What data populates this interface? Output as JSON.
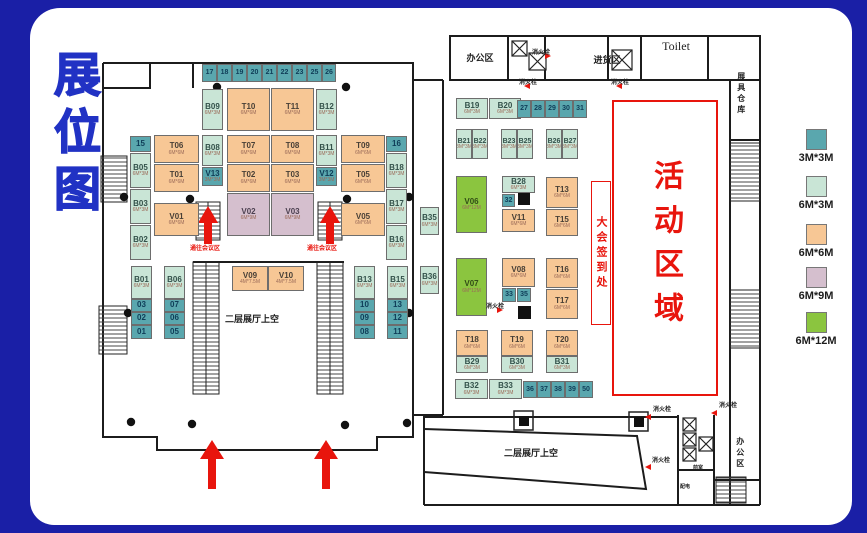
{
  "title": "展位图",
  "zones": {
    "registration": {
      "text": "大会签到处"
    },
    "activity": {
      "text": "活动区域"
    }
  },
  "legend": {
    "x": 806,
    "items": [
      {
        "size": "3M*3M",
        "color": "#5aa7ae",
        "y": 129
      },
      {
        "size": "6M*3M",
        "color": "#c9e5d6",
        "y": 176
      },
      {
        "size": "6M*6M",
        "color": "#f7c795",
        "y": 224
      },
      {
        "size": "6M*9M",
        "color": "#d5bfce",
        "y": 267
      },
      {
        "size": "6M*12M",
        "color": "#8bc53f",
        "y": 312
      }
    ]
  },
  "booth_types": {
    "teal": {
      "size": "3M*3M",
      "color": "#5aa7ae"
    },
    "lg": {
      "size": "6M*3M",
      "color": "#c9e5d6"
    },
    "or": {
      "size": "6M*6M",
      "color": "#f7c795"
    },
    "pu": {
      "size": "6M*9M",
      "color": "#d5bfce"
    },
    "gr": {
      "size": "6M*12M",
      "color": "#8bc53f"
    }
  },
  "accent_colors": {
    "red": "#e8150d",
    "title_blue": "#2132c4",
    "frame_blue": "#1a1fa6"
  },
  "areas": [
    {
      "name": "office-area-top",
      "text": "办公区",
      "x": 454,
      "y": 54,
      "size": 9,
      "w": 52
    },
    {
      "name": "fire-hydrant-label",
      "text": "消火栓",
      "x": 532,
      "y": 50,
      "size": 6
    },
    {
      "name": "goods-area",
      "text": "进货区",
      "x": 577,
      "y": 56,
      "size": 9,
      "w": 60
    },
    {
      "name": "toilet",
      "text": "Toilet",
      "x": 647,
      "y": 40,
      "size": 12,
      "w": 58,
      "serif": true
    },
    {
      "name": "fire-hydrant-label",
      "text": "消火栓",
      "x": 519,
      "y": 80,
      "size": 6
    },
    {
      "name": "fire-hydrant-label",
      "text": "消火栓",
      "x": 611,
      "y": 80,
      "size": 6
    },
    {
      "name": "warehouse",
      "text": "展具仓库",
      "x": 736,
      "y": 72,
      "size": 8,
      "vertical": true
    },
    {
      "name": "to-conference-label",
      "text": "通往会议区",
      "x": 190,
      "y": 246,
      "size": 6,
      "color": "#e8150d"
    },
    {
      "name": "to-conference-label",
      "text": "通往会议区",
      "x": 307,
      "y": 246,
      "size": 6,
      "color": "#e8150d"
    },
    {
      "name": "void-left",
      "text": "二层展厅上空",
      "x": 225,
      "y": 315,
      "size": 9
    },
    {
      "name": "fire-hydrant-label",
      "text": "消火栓",
      "x": 486,
      "y": 304,
      "size": 6
    },
    {
      "name": "void-bottom",
      "text": "二层展厅上空",
      "x": 504,
      "y": 449,
      "size": 9
    },
    {
      "name": "fire-hydrant-label",
      "text": "消火栓",
      "x": 653,
      "y": 407,
      "size": 6
    },
    {
      "name": "fire-hydrant-label",
      "text": "消火栓",
      "x": 719,
      "y": 403,
      "size": 6
    },
    {
      "name": "fire-hydrant-label",
      "text": "消火栓",
      "x": 652,
      "y": 458,
      "size": 6
    },
    {
      "name": "front-room",
      "text": "前室",
      "x": 693,
      "y": 466,
      "size": 5
    },
    {
      "name": "power-room",
      "text": "配电",
      "x": 680,
      "y": 485,
      "size": 5
    },
    {
      "name": "office-area-bottom",
      "text": "办公区",
      "x": 735,
      "y": 437,
      "size": 8,
      "vertical": true
    }
  ],
  "booths": [
    {
      "label": "17",
      "type": "teal",
      "x": 202,
      "y": 64,
      "w": 15,
      "h": 18
    },
    {
      "label": "18",
      "type": "teal",
      "x": 217,
      "y": 64,
      "w": 15,
      "h": 18
    },
    {
      "label": "19",
      "type": "teal",
      "x": 232,
      "y": 64,
      "w": 15,
      "h": 18
    },
    {
      "label": "20",
      "type": "teal",
      "x": 247,
      "y": 64,
      "w": 15,
      "h": 18
    },
    {
      "label": "21",
      "type": "teal",
      "x": 262,
      "y": 64,
      "w": 15,
      "h": 18
    },
    {
      "label": "22",
      "type": "teal",
      "x": 277,
      "y": 64,
      "w": 15,
      "h": 18
    },
    {
      "label": "23",
      "type": "teal",
      "x": 292,
      "y": 64,
      "w": 15,
      "h": 18
    },
    {
      "label": "25",
      "type": "teal",
      "x": 307,
      "y": 64,
      "w": 15,
      "h": 18
    },
    {
      "label": "26",
      "type": "teal",
      "x": 322,
      "y": 64,
      "w": 14,
      "h": 18
    },
    {
      "label": "B09",
      "type": "lg",
      "sub": "6M*3M",
      "x": 202,
      "y": 89,
      "w": 21,
      "h": 41
    },
    {
      "label": "T10",
      "type": "or",
      "sub": "6M*6M",
      "x": 227,
      "y": 88,
      "w": 43,
      "h": 43
    },
    {
      "label": "T11",
      "type": "or",
      "sub": "6M*6M",
      "x": 271,
      "y": 88,
      "w": 43,
      "h": 43
    },
    {
      "label": "B12",
      "type": "lg",
      "sub": "6M*3M",
      "x": 316,
      "y": 89,
      "w": 21,
      "h": 41
    },
    {
      "label": "15",
      "type": "teal",
      "x": 130,
      "y": 136,
      "w": 21,
      "h": 16
    },
    {
      "label": "B05",
      "type": "lg",
      "sub": "6M*3M",
      "x": 130,
      "y": 153,
      "w": 21,
      "h": 35
    },
    {
      "label": "B03",
      "type": "lg",
      "sub": "6M*3M",
      "x": 130,
      "y": 189,
      "w": 21,
      "h": 35
    },
    {
      "label": "B02",
      "type": "lg",
      "sub": "6M*3M",
      "x": 130,
      "y": 225,
      "w": 21,
      "h": 35
    },
    {
      "label": "T06",
      "type": "or",
      "sub": "6M*6M",
      "x": 154,
      "y": 135,
      "w": 45,
      "h": 28
    },
    {
      "label": "T01",
      "type": "or",
      "sub": "6M*6M",
      "x": 154,
      "y": 164,
      "w": 45,
      "h": 28
    },
    {
      "label": "V01",
      "type": "or",
      "sub": "6M*6M",
      "x": 154,
      "y": 203,
      "w": 45,
      "h": 33
    },
    {
      "label": "B08",
      "type": "lg",
      "sub": "6M*3M",
      "x": 202,
      "y": 135,
      "w": 21,
      "h": 31
    },
    {
      "label": "V13",
      "type": "teal",
      "sub": "3M*3M",
      "x": 202,
      "y": 167,
      "w": 21,
      "h": 19
    },
    {
      "label": "T07",
      "type": "or",
      "sub": "6M*6M",
      "x": 227,
      "y": 135,
      "w": 43,
      "h": 28
    },
    {
      "label": "T02",
      "type": "or",
      "sub": "6M*6M",
      "x": 227,
      "y": 164,
      "w": 43,
      "h": 28
    },
    {
      "label": "V02",
      "type": "pu",
      "sub": "6M*9M",
      "x": 227,
      "y": 193,
      "w": 43,
      "h": 43
    },
    {
      "label": "T08",
      "type": "or",
      "sub": "6M*6M",
      "x": 271,
      "y": 135,
      "w": 43,
      "h": 28
    },
    {
      "label": "T03",
      "type": "or",
      "sub": "6M*6M",
      "x": 271,
      "y": 164,
      "w": 43,
      "h": 28
    },
    {
      "label": "V03",
      "type": "pu",
      "sub": "6M*9M",
      "x": 271,
      "y": 193,
      "w": 43,
      "h": 43
    },
    {
      "label": "B11",
      "type": "lg",
      "sub": "6M*3M",
      "x": 316,
      "y": 135,
      "w": 21,
      "h": 31
    },
    {
      "label": "V12",
      "type": "teal",
      "sub": "3M*3M",
      "x": 316,
      "y": 167,
      "w": 21,
      "h": 19
    },
    {
      "label": "T09",
      "type": "or",
      "sub": "6M*6M",
      "x": 341,
      "y": 135,
      "w": 44,
      "h": 28
    },
    {
      "label": "T05",
      "type": "or",
      "sub": "6M*6M",
      "x": 341,
      "y": 164,
      "w": 44,
      "h": 28
    },
    {
      "label": "V05",
      "type": "or",
      "sub": "6M*6M",
      "x": 341,
      "y": 203,
      "w": 44,
      "h": 33
    },
    {
      "label": "16",
      "type": "teal",
      "x": 386,
      "y": 136,
      "w": 21,
      "h": 16
    },
    {
      "label": "B18",
      "type": "lg",
      "sub": "6M*3M",
      "x": 386,
      "y": 153,
      "w": 21,
      "h": 35
    },
    {
      "label": "B17",
      "type": "lg",
      "sub": "6M*3M",
      "x": 386,
      "y": 189,
      "w": 21,
      "h": 35
    },
    {
      "label": "B16",
      "type": "lg",
      "sub": "6M*3M",
      "x": 386,
      "y": 225,
      "w": 21,
      "h": 35
    },
    {
      "label": "B35",
      "type": "lg",
      "sub": "6M*3M",
      "x": 420,
      "y": 207,
      "w": 19,
      "h": 28
    },
    {
      "label": "B01",
      "type": "lg",
      "sub": "6M*3M",
      "x": 131,
      "y": 266,
      "w": 21,
      "h": 33
    },
    {
      "label": "03",
      "type": "teal",
      "x": 131,
      "y": 299,
      "w": 21,
      "h": 13
    },
    {
      "label": "02",
      "type": "teal",
      "x": 131,
      "y": 312,
      "w": 21,
      "h": 13
    },
    {
      "label": "01",
      "type": "teal",
      "x": 131,
      "y": 325,
      "w": 21,
      "h": 14
    },
    {
      "label": "B06",
      "type": "lg",
      "sub": "6M*3M",
      "x": 164,
      "y": 266,
      "w": 21,
      "h": 33
    },
    {
      "label": "07",
      "type": "teal",
      "x": 164,
      "y": 299,
      "w": 21,
      "h": 13
    },
    {
      "label": "06",
      "type": "teal",
      "x": 164,
      "y": 312,
      "w": 21,
      "h": 13
    },
    {
      "label": "05",
      "type": "teal",
      "x": 164,
      "y": 325,
      "w": 21,
      "h": 14
    },
    {
      "label": "V09",
      "type": "or",
      "sub": "4M*7.5M",
      "x": 232,
      "y": 266,
      "w": 36,
      "h": 25
    },
    {
      "label": "V10",
      "type": "or",
      "sub": "4M*7.5M",
      "x": 268,
      "y": 266,
      "w": 36,
      "h": 25
    },
    {
      "label": "B13",
      "type": "lg",
      "sub": "6M*3M",
      "x": 354,
      "y": 266,
      "w": 21,
      "h": 33
    },
    {
      "label": "10",
      "type": "teal",
      "x": 354,
      "y": 299,
      "w": 21,
      "h": 13
    },
    {
      "label": "09",
      "type": "teal",
      "x": 354,
      "y": 312,
      "w": 21,
      "h": 13
    },
    {
      "label": "08",
      "type": "teal",
      "x": 354,
      "y": 325,
      "w": 21,
      "h": 14
    },
    {
      "label": "B15",
      "type": "lg",
      "sub": "6M*3M",
      "x": 387,
      "y": 266,
      "w": 21,
      "h": 33
    },
    {
      "label": "13",
      "type": "teal",
      "x": 387,
      "y": 299,
      "w": 21,
      "h": 13
    },
    {
      "label": "12",
      "type": "teal",
      "x": 387,
      "y": 312,
      "w": 21,
      "h": 13
    },
    {
      "label": "11",
      "type": "teal",
      "x": 387,
      "y": 325,
      "w": 21,
      "h": 14
    },
    {
      "label": "B36",
      "type": "lg",
      "sub": "6M*3M",
      "x": 420,
      "y": 266,
      "w": 19,
      "h": 28
    },
    {
      "label": "B19",
      "type": "lg",
      "sub": "6M*3M",
      "x": 456,
      "y": 98,
      "w": 32,
      "h": 21
    },
    {
      "label": "B20",
      "type": "lg",
      "sub": "6M*3M",
      "x": 489,
      "y": 98,
      "w": 32,
      "h": 21
    },
    {
      "label": "27",
      "type": "teal",
      "x": 517,
      "y": 100,
      "w": 14,
      "h": 18
    },
    {
      "label": "28",
      "type": "teal",
      "x": 531,
      "y": 100,
      "w": 14,
      "h": 18
    },
    {
      "label": "29",
      "type": "teal",
      "x": 545,
      "y": 100,
      "w": 14,
      "h": 18
    },
    {
      "label": "30",
      "type": "teal",
      "x": 559,
      "y": 100,
      "w": 14,
      "h": 18
    },
    {
      "label": "31",
      "type": "teal",
      "x": 573,
      "y": 100,
      "w": 14,
      "h": 18
    },
    {
      "label": "B21",
      "type": "lg",
      "sub": "3M*3M",
      "x": 456,
      "y": 129,
      "w": 16,
      "h": 30
    },
    {
      "label": "B22",
      "type": "lg",
      "sub": "3M*3M",
      "x": 472,
      "y": 129,
      "w": 16,
      "h": 30
    },
    {
      "label": "B23",
      "type": "lg",
      "sub": "3M*3M",
      "x": 501,
      "y": 129,
      "w": 16,
      "h": 30
    },
    {
      "label": "B25",
      "type": "lg",
      "sub": "3M*3M",
      "x": 517,
      "y": 129,
      "w": 16,
      "h": 30
    },
    {
      "label": "B26",
      "type": "lg",
      "sub": "3M*3M",
      "x": 546,
      "y": 129,
      "w": 16,
      "h": 30
    },
    {
      "label": "B27",
      "type": "lg",
      "sub": "3M*3M",
      "x": 562,
      "y": 129,
      "w": 16,
      "h": 30
    },
    {
      "label": "V06",
      "type": "gr",
      "sub": "6M*12M",
      "x": 456,
      "y": 176,
      "w": 31,
      "h": 57
    },
    {
      "label": "B28",
      "type": "lg",
      "sub": "6M*3M",
      "x": 502,
      "y": 176,
      "w": 33,
      "h": 17
    },
    {
      "label": "32",
      "type": "teal",
      "x": 502,
      "y": 194,
      "w": 13,
      "h": 13
    },
    {
      "label": "V11",
      "type": "or",
      "sub": "6M*6M",
      "x": 502,
      "y": 209,
      "w": 33,
      "h": 23
    },
    {
      "label": "T13",
      "type": "or",
      "sub": "6M*6M",
      "x": 546,
      "y": 177,
      "w": 32,
      "h": 31
    },
    {
      "label": "T15",
      "type": "or",
      "sub": "6M*6M",
      "x": 546,
      "y": 209,
      "w": 32,
      "h": 27
    },
    {
      "label": "V07",
      "type": "gr",
      "sub": "6M*12M",
      "x": 456,
      "y": 258,
      "w": 31,
      "h": 58
    },
    {
      "label": "V08",
      "type": "or",
      "sub": "6M*6M",
      "x": 502,
      "y": 258,
      "w": 33,
      "h": 29
    },
    {
      "label": "33",
      "type": "teal",
      "x": 502,
      "y": 288,
      "w": 14,
      "h": 14
    },
    {
      "label": "35",
      "type": "teal",
      "x": 517,
      "y": 288,
      "w": 14,
      "h": 14
    },
    {
      "label": "T16",
      "type": "or",
      "sub": "6M*6M",
      "x": 546,
      "y": 258,
      "w": 32,
      "h": 30
    },
    {
      "label": "T17",
      "type": "or",
      "sub": "6M*6M",
      "x": 546,
      "y": 289,
      "w": 32,
      "h": 30
    },
    {
      "label": "T18",
      "type": "or",
      "sub": "6M*6M",
      "x": 456,
      "y": 330,
      "w": 32,
      "h": 26
    },
    {
      "label": "B29",
      "type": "lg",
      "sub": "6M*3M",
      "x": 456,
      "y": 356,
      "w": 32,
      "h": 17
    },
    {
      "label": "T19",
      "type": "or",
      "sub": "6M*6M",
      "x": 501,
      "y": 330,
      "w": 32,
      "h": 26
    },
    {
      "label": "B30",
      "type": "lg",
      "sub": "6M*3M",
      "x": 501,
      "y": 356,
      "w": 32,
      "h": 17
    },
    {
      "label": "T20",
      "type": "or",
      "sub": "6M*6M",
      "x": 546,
      "y": 330,
      "w": 32,
      "h": 26
    },
    {
      "label": "B31",
      "type": "lg",
      "sub": "6M*3M",
      "x": 546,
      "y": 356,
      "w": 32,
      "h": 17
    },
    {
      "label": "B32",
      "type": "lg",
      "sub": "6M*3M",
      "x": 455,
      "y": 379,
      "w": 33,
      "h": 20
    },
    {
      "label": "B33",
      "type": "lg",
      "sub": "6M*3M",
      "x": 489,
      "y": 379,
      "w": 33,
      "h": 20
    },
    {
      "label": "36",
      "type": "teal",
      "x": 523,
      "y": 381,
      "w": 14,
      "h": 17
    },
    {
      "label": "37",
      "type": "teal",
      "x": 537,
      "y": 381,
      "w": 14,
      "h": 17
    },
    {
      "label": "38",
      "type": "teal",
      "x": 551,
      "y": 381,
      "w": 14,
      "h": 17
    },
    {
      "label": "39",
      "type": "teal",
      "x": 565,
      "y": 381,
      "w": 14,
      "h": 17
    },
    {
      "label": "50",
      "type": "teal",
      "x": 579,
      "y": 381,
      "w": 14,
      "h": 17
    }
  ]
}
